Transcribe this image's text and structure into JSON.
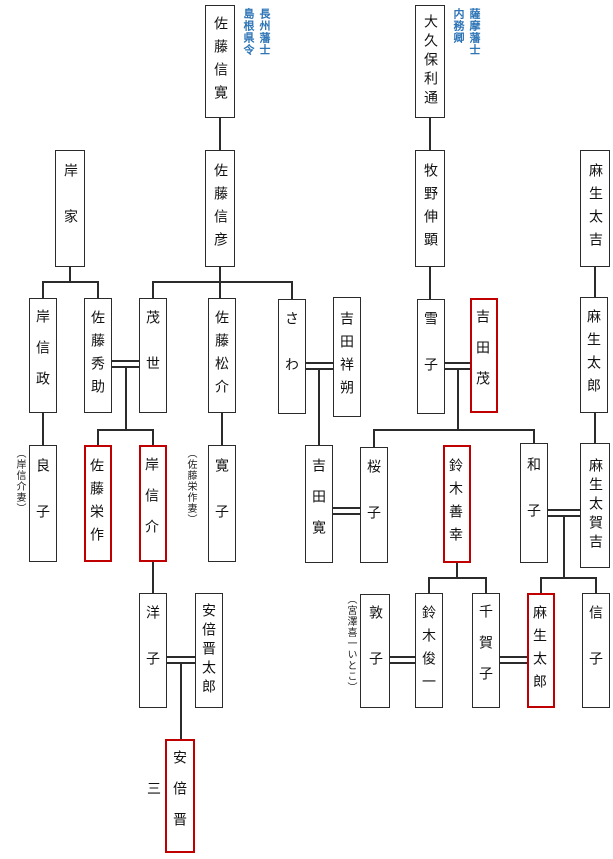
{
  "diagram": {
    "type": "family-tree",
    "colors": {
      "background": "#ffffff",
      "box_border": "#2b2b2b",
      "highlight_border": "#c00000",
      "line": "#2b2b2b",
      "annotation_blue": "#2e75b6",
      "text": "#111111"
    },
    "people": {
      "sato_nobuhiro": {
        "name": "佐藤信寛",
        "highlighted": false
      },
      "okubo_toshimichi": {
        "name": "大久保利通",
        "highlighted": false
      },
      "kishi_family": {
        "name": "岸家",
        "highlighted": false
      },
      "sato_nobuhiko": {
        "name": "佐藤信彦",
        "highlighted": false
      },
      "makino_nobuaki": {
        "name": "牧野伸顕",
        "highlighted": false
      },
      "aso_takichi": {
        "name": "麻生太吉",
        "highlighted": false
      },
      "kishi_nobumasa": {
        "name": "岸信政",
        "highlighted": false
      },
      "sato_hidesuke": {
        "name": "佐藤秀助",
        "highlighted": false
      },
      "moyo": {
        "name": "茂世",
        "highlighted": false
      },
      "sato_matsusuke": {
        "name": "佐藤松介",
        "highlighted": false
      },
      "sawa": {
        "name": "さわ",
        "highlighted": false
      },
      "yoshida_shosaku": {
        "name": "吉田祥朔",
        "highlighted": false
      },
      "yukiko": {
        "name": "雪子",
        "highlighted": false
      },
      "yoshida_shigeru": {
        "name": "吉田茂",
        "highlighted": true
      },
      "aso_taro_elder": {
        "name": "麻生太郎",
        "highlighted": false
      },
      "ryoko": {
        "name": "良子",
        "highlighted": false
      },
      "sato_eisaku": {
        "name": "佐藤栄作",
        "highlighted": true
      },
      "kishi_nobusuke": {
        "name": "岸信介",
        "highlighted": true
      },
      "hiroko": {
        "name": "寛子",
        "highlighted": false
      },
      "yoshida_hiroshi": {
        "name": "吉田寛",
        "highlighted": false
      },
      "sakurako": {
        "name": "桜子",
        "highlighted": false
      },
      "suzuki_zenko": {
        "name": "鈴木善幸",
        "highlighted": true
      },
      "kazuko": {
        "name": "和子",
        "highlighted": false
      },
      "aso_takakichi": {
        "name": "麻生太賀吉",
        "highlighted": false
      },
      "yoko": {
        "name": "洋子",
        "highlighted": false
      },
      "abe_shintaro": {
        "name": "安倍晋太郎",
        "highlighted": false
      },
      "atsuko": {
        "name": "敦子",
        "highlighted": false
      },
      "suzuki_shunichi": {
        "name": "鈴木俊一",
        "highlighted": false
      },
      "chikako": {
        "name": "千賀子",
        "highlighted": false
      },
      "aso_taro": {
        "name": "麻生太郎",
        "highlighted": true
      },
      "nobuko": {
        "name": "信子",
        "highlighted": false
      },
      "abe_shinzo": {
        "name": "安倍晋三",
        "highlighted": true
      }
    },
    "annotations": {
      "sato_nobuhiro_note": "長州藩士\n島根県令",
      "okubo_note": "薩摩藩士\n内務卿",
      "ryoko_note": "（岸信介妻）",
      "hiroko_note": "（佐藤栄作妻）",
      "atsuko_note": "（宮澤喜一いとこ）"
    }
  }
}
